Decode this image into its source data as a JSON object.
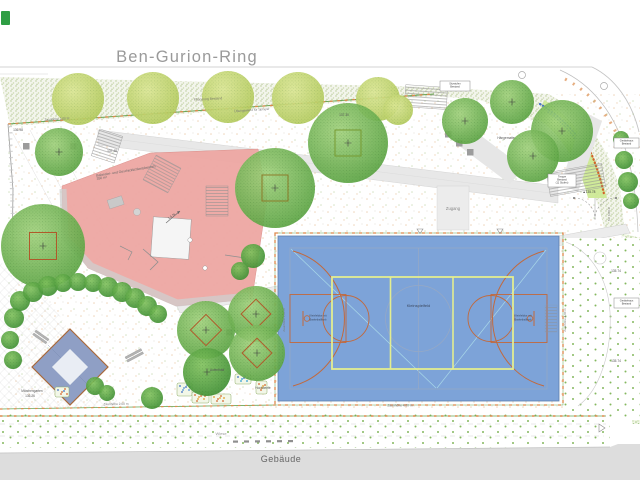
{
  "street": {
    "name": "Ben-Gurion-Ring"
  },
  "building": {
    "label": "Gebäude"
  },
  "court": {
    "center_label": "Kleinspielfeld",
    "goal_label_line1": "Kleinfeldtor mit",
    "goal_label_line2": "Basketballkorb",
    "fence_label_bottom": "Zaunhöhe 4,00 m",
    "fence_label_right": "Zaunhöhe 4,00 m",
    "fence_label_left": "Zaunhöhe 4,00 m",
    "fill": "#7da3d8",
    "line_orange": "#c2693c",
    "line_yellow": "#e9f18c",
    "line_blue": "#97a9c4"
  },
  "play_area": {
    "fill": "#eea7a3"
  },
  "sand_diamond": {
    "fill": "#8f9fc5"
  },
  "labels": [
    {
      "text": "Pflanzung Bestand",
      "x": 208,
      "y": 100,
      "rot": -3,
      "size": 3.4,
      "color": "#7a7a68"
    },
    {
      "text": "Zaunhöhe 2,00 m",
      "x": 57,
      "y": 120,
      "rot": -4,
      "size": 3.2,
      "color": "#777777"
    },
    {
      "text": "Übungswand für Sprayer",
      "x": 252,
      "y": 111,
      "rot": -4,
      "size": 3.2,
      "color": "#777777"
    },
    {
      "text": "136.98",
      "x": 18,
      "y": 131,
      "rot": 0,
      "size": 3.2,
      "color": "#555555"
    },
    {
      "text": "137.48",
      "x": 112,
      "y": 152,
      "rot": 0,
      "size": 3.2,
      "color": "#555555"
    },
    {
      "text": "137.30",
      "x": 344,
      "y": 116,
      "rot": 0,
      "size": 3.2,
      "color": "#555555"
    },
    {
      "text": "Balancier- und Geschicklichkeitsbereich",
      "x": 126,
      "y": 172,
      "rot": -9,
      "size": 3.4,
      "color": "#666666"
    },
    {
      "text": "350 m²",
      "x": 102,
      "y": 179,
      "rot": -9,
      "size": 3.4,
      "color": "#666666"
    },
    {
      "text": "1,5 %",
      "x": 172,
      "y": 217,
      "rot": -35,
      "size": 3.2,
      "color": "#555555"
    },
    {
      "text": "Zugang",
      "x": 453,
      "y": 210,
      "rot": 0,
      "size": 4.2,
      "color": "#888888"
    },
    {
      "text": "Hängematte",
      "x": 506,
      "y": 139,
      "rot": 0,
      "size": 3.2,
      "color": "#555555"
    },
    {
      "text": "Aufenthalt",
      "x": 217,
      "y": 371,
      "rot": 0,
      "size": 3.2,
      "color": "#555555"
    },
    {
      "text": "Hochbeete",
      "x": 263,
      "y": 389,
      "rot": 0,
      "size": 3.2,
      "color": "#555555"
    },
    {
      "text": "Märchengarten",
      "x": 32,
      "y": 392,
      "rot": 0,
      "size": 3.2,
      "color": "#555555"
    },
    {
      "text": "136.26",
      "x": 30,
      "y": 397,
      "rot": 0,
      "size": 3.2,
      "color": "#555555"
    },
    {
      "text": "▲135.78",
      "x": 589,
      "y": 193,
      "rot": 0,
      "size": 3.2,
      "color": "#444444"
    },
    {
      "text": "135.74",
      "x": 616,
      "y": 272,
      "rot": 0,
      "size": 3.2,
      "color": "#555555"
    },
    {
      "text": "135.74",
      "x": 616,
      "y": 362,
      "rot": 0,
      "size": 3.2,
      "color": "#555555"
    },
    {
      "text": "Wiese",
      "x": 221,
      "y": 435,
      "rot": 0,
      "size": 4.0,
      "color": "#999999"
    },
    {
      "text": "Zaunhöhe 2,00 m",
      "x": 116,
      "y": 405,
      "rot": -1,
      "size": 3.2,
      "color": "#777777"
    },
    {
      "text": "Tor 4,00 m",
      "x": 610,
      "y": 214,
      "rot": -90,
      "size": 3.0,
      "color": "#666666"
    }
  ],
  "boxes": [
    {
      "x": 440,
      "y": 81,
      "w": 30,
      "h": 10,
      "lines": [
        "Sitzstufen",
        "Bestand"
      ]
    },
    {
      "x": 548,
      "y": 174,
      "w": 28,
      "h": 13,
      "lines": [
        "Treppe",
        "Bestand",
        "(11 Stufen)"
      ]
    },
    {
      "x": 614,
      "y": 298,
      "w": 25,
      "h": 10,
      "lines": [
        "Gerätehaus",
        "Bestand"
      ]
    },
    {
      "x": 614,
      "y": 138,
      "w": 25,
      "h": 10,
      "lines": [
        "Gerätehaus",
        "Bestand"
      ]
    }
  ],
  "trees": {
    "light": [
      [
        78,
        99,
        26
      ],
      [
        153,
        98,
        26
      ],
      [
        228,
        97,
        26
      ],
      [
        298,
        98,
        26
      ],
      [
        378,
        99,
        22
      ],
      [
        398,
        110,
        15
      ]
    ],
    "medium": [
      [
        59,
        152,
        24
      ],
      [
        465,
        121,
        23
      ],
      [
        512,
        102,
        22
      ],
      [
        562,
        131,
        31
      ],
      [
        533,
        156,
        26
      ]
    ],
    "marked": [
      {
        "x": 275,
        "y": 188,
        "r": 40,
        "sq": 26,
        "rot": 0,
        "c": "#8a7a28"
      },
      {
        "x": 348,
        "y": 143,
        "r": 40,
        "sq": 26,
        "rot": 0,
        "c": "#74982f"
      },
      {
        "x": 43,
        "y": 246,
        "r": 42,
        "sq": 27,
        "rot": 0,
        "c": "#b05a2a"
      },
      {
        "x": 206,
        "y": 330,
        "r": 29,
        "sq": 22,
        "rot": 45,
        "c": "#b05a2a"
      },
      {
        "x": 256,
        "y": 314,
        "r": 28,
        "sq": 21,
        "rot": 45,
        "c": "#b05a2a"
      },
      {
        "x": 257,
        "y": 353,
        "r": 28,
        "sq": 21,
        "rot": 45,
        "c": "#b05a2a"
      }
    ],
    "dark": [
      [
        207,
        372,
        24
      ]
    ],
    "bushes": [
      [
        14,
        318,
        10
      ],
      [
        20,
        301,
        10
      ],
      [
        33,
        292,
        10
      ],
      [
        48,
        286,
        10
      ],
      [
        63,
        283,
        9
      ],
      [
        78,
        282,
        9
      ],
      [
        93,
        283,
        9
      ],
      [
        108,
        287,
        10
      ],
      [
        122,
        292,
        10
      ],
      [
        135,
        298,
        10
      ],
      [
        147,
        306,
        10
      ],
      [
        158,
        314,
        9
      ],
      [
        10,
        340,
        9
      ],
      [
        13,
        360,
        9
      ],
      [
        95,
        386,
        9
      ],
      [
        107,
        393,
        8
      ],
      [
        152,
        398,
        11
      ],
      [
        253,
        256,
        12
      ],
      [
        240,
        271,
        9
      ],
      [
        621,
        139,
        8
      ],
      [
        624,
        160,
        9
      ],
      [
        628,
        182,
        10
      ],
      [
        631,
        201,
        8
      ]
    ]
  },
  "benches": [
    {
      "x": 36,
      "y": 330,
      "rot": 35,
      "w": 16
    },
    {
      "x": 125,
      "y": 357,
      "rot": -28,
      "w": 18
    }
  ],
  "squares": [
    [
      23,
      143
    ],
    [
      70,
      143
    ],
    [
      445,
      131
    ],
    [
      456,
      140
    ],
    [
      467,
      149
    ],
    [
      226,
      329
    ]
  ],
  "beds": [
    {
      "x": 55,
      "y": 387,
      "w": 14,
      "h": 10,
      "c1": "#3a6bc4",
      "c2": "#d2622a"
    },
    {
      "x": 177,
      "y": 383,
      "w": 15,
      "h": 13,
      "c1": "#3a6bc4",
      "c2": "#4a8fd4"
    },
    {
      "x": 192,
      "y": 392,
      "w": 17,
      "h": 11,
      "c1": "#d2622a",
      "c2": "#e09a2a"
    },
    {
      "x": 211,
      "y": 394,
      "w": 20,
      "h": 10,
      "c1": "#e09a2a",
      "c2": "#d2622a"
    },
    {
      "x": 235,
      "y": 374,
      "w": 16,
      "h": 10,
      "c1": "#3a6bc4",
      "c2": "#2a9ad2"
    },
    {
      "x": 256,
      "y": 381,
      "w": 11,
      "h": 13,
      "c1": "#d2622a",
      "c2": "#e09a2a"
    }
  ]
}
